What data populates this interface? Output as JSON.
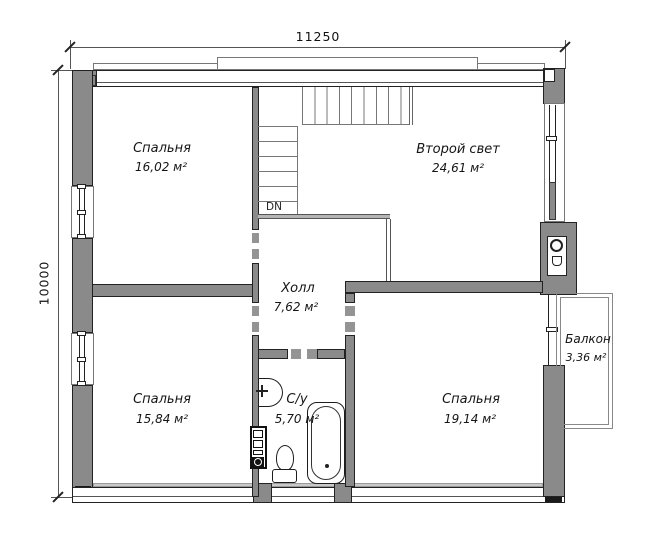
{
  "dimensions": {
    "width": "11250",
    "height": "10000"
  },
  "rooms": {
    "bedroom_top": {
      "name": "Спальня",
      "area": "16,02 м²"
    },
    "second_light": {
      "name": "Второй свет",
      "area": "24,61 м²"
    },
    "hall": {
      "name": "Холл",
      "area": "7,62 м²"
    },
    "bedroom_left": {
      "name": "Спальня",
      "area": "15,84 м²"
    },
    "bathroom": {
      "name": "С/у",
      "area": "5,70 м²"
    },
    "bedroom_right": {
      "name": "Спальня",
      "area": "19,14 м²"
    },
    "balcony": {
      "name": "Балкон",
      "area": "3,36 м²"
    }
  },
  "stairs": {
    "direction_label": "DN"
  },
  "colors": {
    "wall_fill": "#8a8a8a",
    "wall_outline": "#222222",
    "light_band": "#c9c9c9",
    "text": "#151515"
  }
}
